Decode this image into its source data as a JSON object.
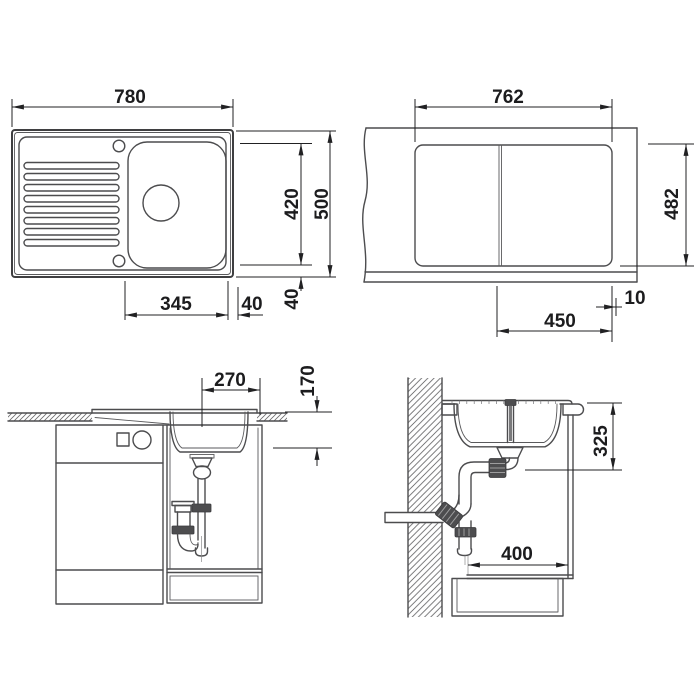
{
  "document": {
    "type": "technical-installation-drawing",
    "subject": "inset kitchen sink with drainboard",
    "background_color": "#ffffff",
    "line_color": "#4c4c4e",
    "dimension_color": "#1c1c1e"
  },
  "views": {
    "sink_top_view": {
      "label": "sink plan view",
      "dims": {
        "overall_width": "780",
        "overall_depth": "500",
        "bowl_zone_depth": "420",
        "bowl_zone_width": "345",
        "bowl_offset_right": "40",
        "bowl_offset_bottom": "40"
      }
    },
    "cutout_view": {
      "label": "worktop cut-out plan",
      "dims": {
        "cutout_width": "762",
        "cutout_depth": "482",
        "edge_offset": "10",
        "drain_offset": "450"
      }
    },
    "front_section_view": {
      "label": "front section through cabinet",
      "dims": {
        "bowl_bottom_width": "270",
        "bowl_depth": "170"
      }
    },
    "side_section_view": {
      "label": "side section at wall",
      "dims": {
        "drain_height": "325",
        "cabinet_inner_depth": "400"
      }
    }
  }
}
